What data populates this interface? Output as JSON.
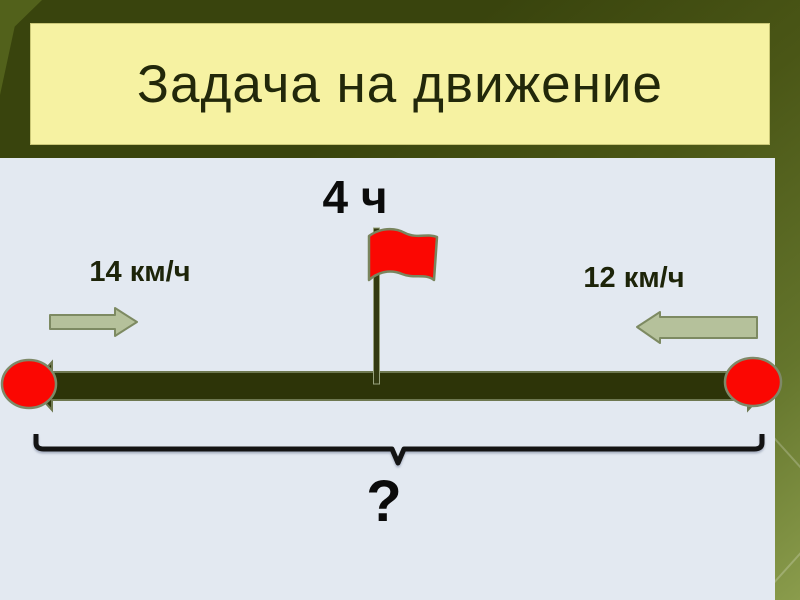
{
  "slide": {
    "title": "Задача на движение",
    "diagram": {
      "time_label": "4 ч",
      "speed_left": "14 км/ч",
      "speed_right": "12 км/ч",
      "distance_question": "?"
    }
  },
  "icons": {
    "flag": "red-flag-icon",
    "arrow_right": "arrow-right-icon",
    "arrow_left": "arrow-left-icon",
    "endpoints": "red-endpoint-dot",
    "brace": "distance-brace"
  },
  "colors": {
    "bg-dark": "#39440d",
    "bg-mid": "#4a5616",
    "bg-light": "#8a9c4c",
    "title-bg": "#f6f2a2",
    "title-text": "#22280a",
    "panel-bg": "#e3e9f1",
    "bar": "#2d3408",
    "bar-outline": "#6e7850",
    "red": "#fb0702",
    "shape-outline": "#7e8968",
    "arrow-fill": "#b5c19b",
    "arrow-stroke": "#7d8a62",
    "label-text": "#1d2409",
    "ink": "#0b0b0b"
  }
}
